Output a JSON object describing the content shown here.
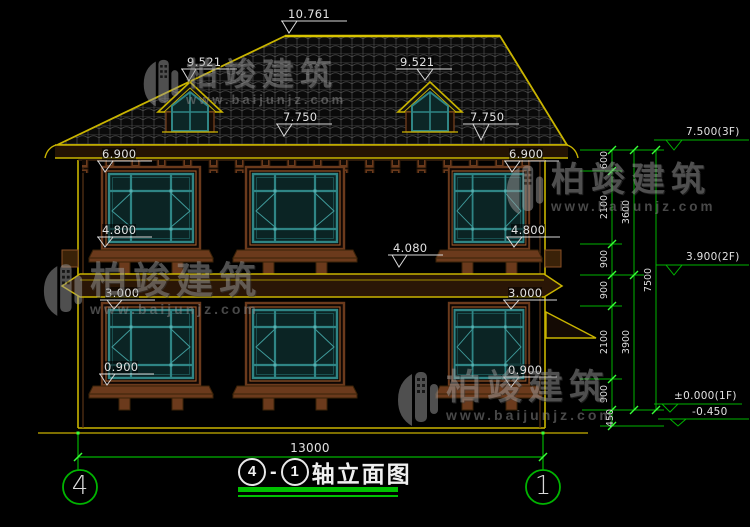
{
  "drawing": {
    "title": {
      "axis_start": "4",
      "axis_end": "1",
      "name": "轴立面图"
    },
    "axis_bubbles": {
      "left": "4",
      "right": "1"
    },
    "labels": {
      "ridge": "10.761",
      "dormer_left": "9.521",
      "dormer_right": "9.521",
      "roof_left": "7.750",
      "roof_right": "7.750",
      "eave_left": "6.900",
      "eave_right": "6.900",
      "sill2_left": "4.800",
      "sill2_right": "4.800",
      "belt": "4.080",
      "win1_left": "3.000",
      "win1_right": "3.000",
      "sill1_left": "0.900",
      "sill1_right": "0.900",
      "width_total": "13000"
    },
    "right_dims": {
      "chain_inner": [
        "600",
        "2100",
        "900",
        "900",
        "2100",
        "900",
        "450"
      ],
      "chain_mid": [
        "3600",
        "3900"
      ],
      "chain_outer": [
        "7500"
      ],
      "elevations": [
        "7.500(3F)",
        "3.900(2F)",
        "±0.000(1F)",
        "-0.450"
      ]
    },
    "watermark": {
      "brand": "柏竣建筑",
      "url": "www.baijunjz.com"
    },
    "colors": {
      "cad_yellow": "#c9b400",
      "cad_green": "#00c000",
      "frame_brown": "#7a4422",
      "window_teal": "#2f8585",
      "dim_white": "#e2e2e2"
    }
  }
}
